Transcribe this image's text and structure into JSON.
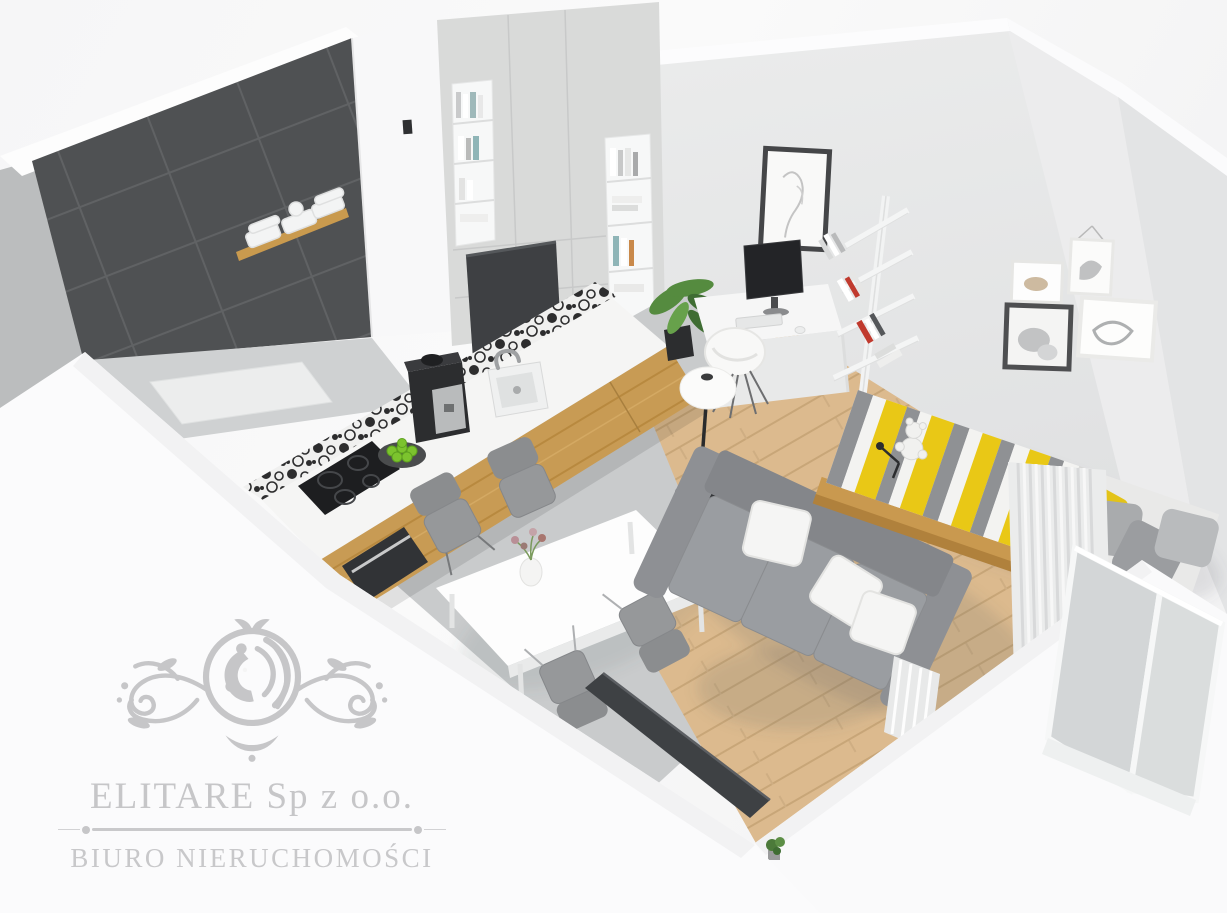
{
  "watermark": {
    "company_name": "ELITARE Sp z o.o.",
    "tagline": "BIURO NIERUCHOMOŚCI",
    "emblem": "lion-crest-with-scroll-flourishes",
    "color": "#c6c6c8"
  },
  "scene": {
    "type": "3d-isometric-apartment-render",
    "style": "scandinavian studio apartment, top-down cutaway visualization",
    "rooms": [
      "bathroom",
      "kitchen",
      "dining area",
      "living room",
      "sleeping nook",
      "work corner"
    ],
    "objects": [
      "dark graphite tiled bathroom wall",
      "wooden shelf with folded white towels",
      "light grey wardrobe wall with open book niches",
      "white kitchen worktop with oak cabinet fronts",
      "black-and-white patterned tile backsplash",
      "espresso machine",
      "inset sink with chrome tap",
      "black induction hob and built-in oven",
      "plate of green apples",
      "white dining table with flower vase",
      "four grey dining chairs",
      "grey three-seat sofa with white cushions",
      "round white coffee table with brass legs and succulent",
      "black floor lamp with white shade",
      "daybed with yellow-grey striped throw and teddy bear",
      "grey and yellow scatter pillows",
      "white pleated curtains and balcony doors",
      "white desk with monitor, keyboard and mouse",
      "white shell desk chair",
      "zig-zag wall bookshelf with books",
      "potted green plants",
      "framed line-art sketch",
      "gallery wall of four small frames",
      "wall-mounted TV panel",
      "oak plank flooring and grey concrete kitchen floor"
    ],
    "palette": {
      "background": "#f7f7f8",
      "outer_walls": "#fbfbfc",
      "interior_wall": "#e7e8e9",
      "dark_tile": "#56585a",
      "wardrobe": "#d8d9d9",
      "oak_wood": "#c89b54",
      "wood_floor": "#dcba8e",
      "concrete_floor": "#c8cacb",
      "sofa_grey": "#94969a",
      "accent_yellow": "#e9c816",
      "plant_green": "#55883f",
      "apple_green": "#79c22f",
      "appliance_black": "#2a2b2d",
      "watermark_grey": "#c6c6c8"
    }
  }
}
